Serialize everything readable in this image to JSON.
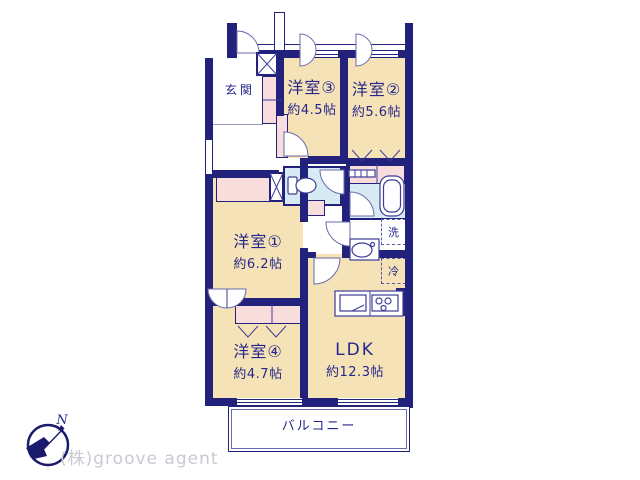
{
  "floorplan": {
    "rooms": {
      "room3": {
        "name": "洋室③",
        "size": "約4.5帖"
      },
      "room2": {
        "name": "洋室②",
        "size": "約5.6帖"
      },
      "room1": {
        "name": "洋室①",
        "size": "約6.2帖"
      },
      "room4": {
        "name": "洋室④",
        "size": "約4.7帖"
      },
      "ldk": {
        "name": "LDK",
        "size": "約12.3帖"
      }
    },
    "labels": {
      "entrance": "玄関",
      "balcony": "バルコニー",
      "laundry": "洗",
      "refrigerator": "冷",
      "north": "N"
    },
    "colors": {
      "wall": "#22227d",
      "room_fill": "#f5e3b7",
      "closet_fill": "#f9dcdc",
      "wet_area_fill": "#d8ebf5",
      "watermark_text": "#c9c9d2"
    }
  },
  "footer": {
    "company": "(株)groove agent"
  }
}
